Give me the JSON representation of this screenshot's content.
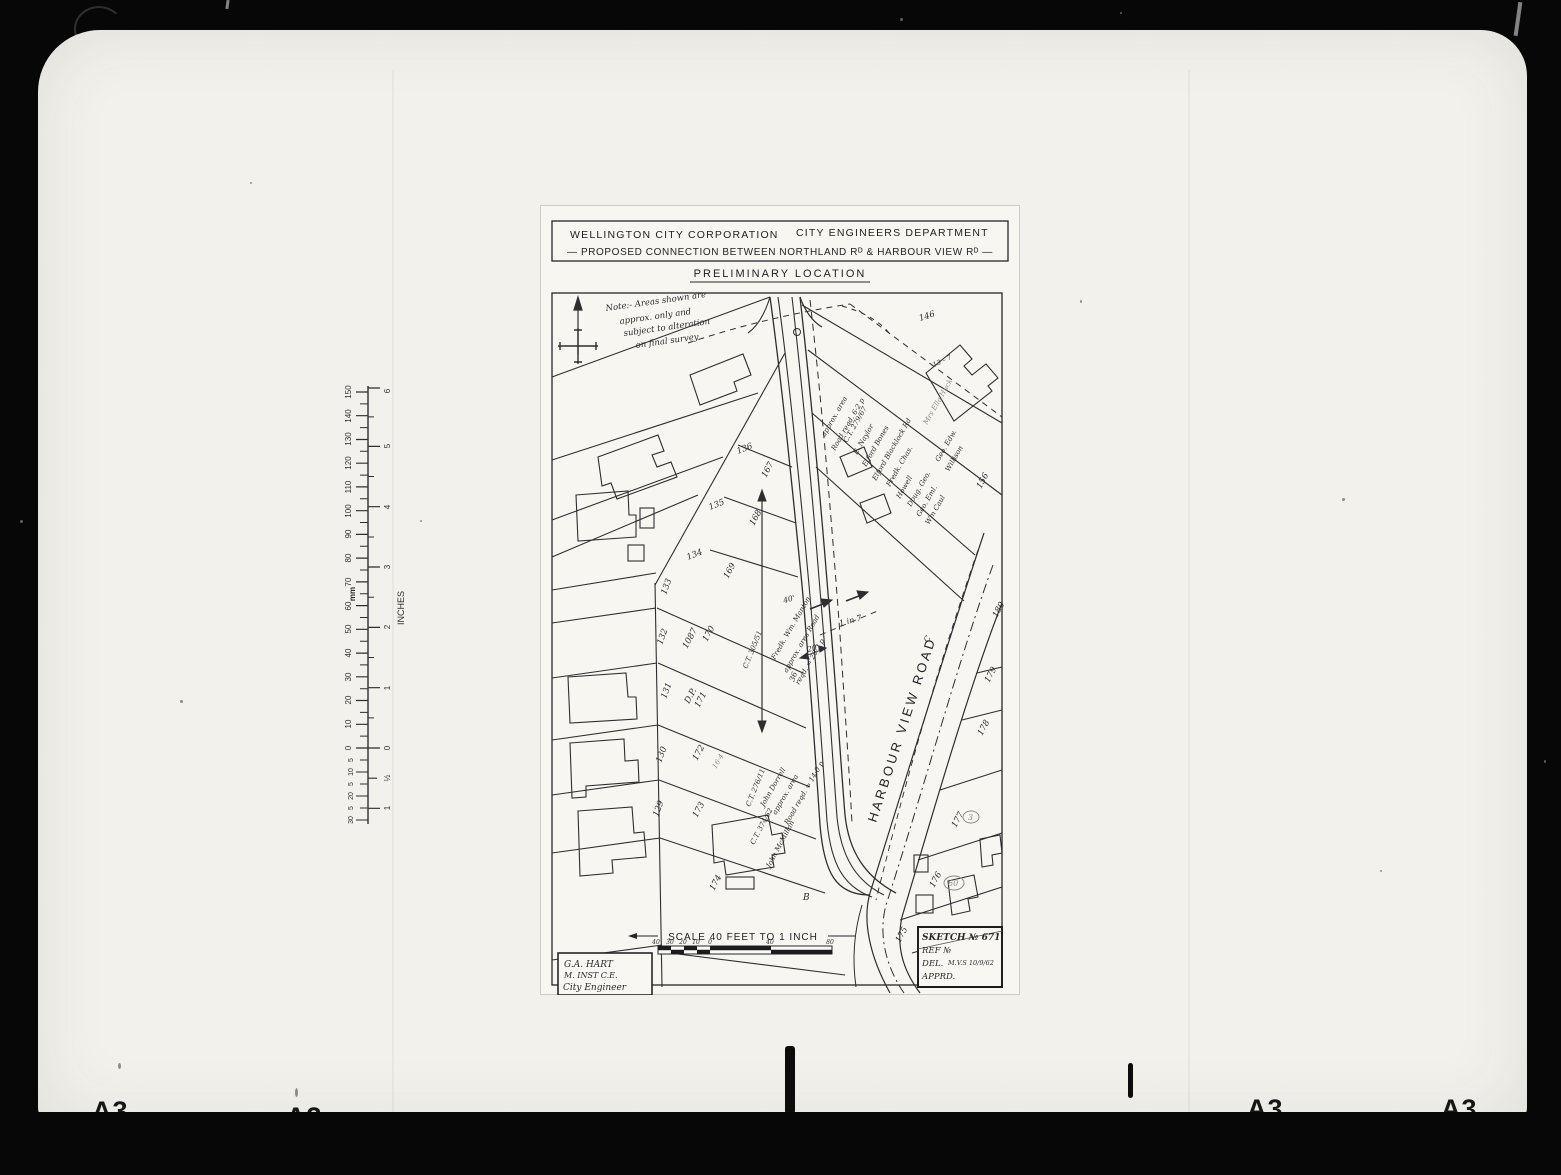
{
  "frame": {
    "a3_labels": [
      "A3",
      "A3",
      "A3",
      "A3"
    ]
  },
  "ruler": {
    "mm_unit": "mm",
    "inch_unit": "INCHES",
    "mm_numbers": [
      "150",
      "140",
      "130",
      "120",
      "110",
      "100",
      "90",
      "80",
      "70",
      "60",
      "50",
      "40",
      "30",
      "20",
      "10",
      "0"
    ],
    "mm_below_zero": [
      "5",
      "10",
      "5",
      "20",
      "5",
      "30"
    ],
    "inch_numbers": [
      "6",
      "5",
      "4",
      "3",
      "2",
      "1",
      "0"
    ],
    "inch_below_zero": [
      "½",
      "1"
    ]
  },
  "title_block": {
    "organisation": "WELLINGTON CITY CORPORATION",
    "department": "CITY ENGINEERS DEPARTMENT",
    "subject": "— PROPOSED CONNECTION BETWEEN NORTHLAND Rᴰ & HARBOUR VIEW Rᴰ —",
    "stage": "PRELIMINARY LOCATION"
  },
  "map": {
    "note": [
      "Note:- Areas shown are",
      "approx. only and",
      "subject to alteration",
      "on final survey"
    ],
    "road_name": "HARBOUR VIEW ROAD",
    "centerline_letter": "C",
    "point_b": "B",
    "lot_numbers": [
      "136",
      "135",
      "134",
      "133",
      "132",
      "131",
      "130",
      "129",
      "170",
      "171",
      "172",
      "173",
      "174",
      "175",
      "176",
      "177",
      "178",
      "179",
      "180",
      "146",
      "156",
      "167",
      "168",
      "169"
    ],
    "plan_ref": {
      "dp": "D.P.",
      "number": "1087"
    },
    "dimensions": {
      "d40": "40'",
      "d20": "20'",
      "d36": "36",
      "grade": "1 in 7",
      "house": "13 – 7"
    },
    "pencil_marks": [
      "60",
      "3"
    ],
    "annotations": {
      "manton": [
        "C.T. 305/51",
        "Fredk. Wm. Manton",
        "approx. area  Road",
        "reqd. = 20·2 p"
      ],
      "dorrell": [
        "C.T. 276/11",
        "John Dorrell",
        "approx. area",
        "Road reqd. = 14·0 p"
      ],
      "mcmillan": [
        "C.T. 374/62",
        "John McMillan"
      ],
      "owners": [
        "approx. area",
        "Road reqd. 6·2 p",
        "C.T. 279/67",
        "E. Naylor",
        "Elford Bones",
        "Elford Blacklock Rd",
        "Fredk. Chas.",
        "Howell",
        "Doug. Geo.",
        "Geo. Eml.",
        "Wm Caul",
        "Geo. Edw.",
        "Willison"
      ],
      "pencil_name": "Mrs Ella Huck",
      "pencil_area": "16·4"
    }
  },
  "scale_bar": {
    "label": "SCALE 40 FEET TO 1 INCH",
    "left_ticks": [
      "40",
      "30",
      "20",
      "10"
    ],
    "zero": "0",
    "right_ticks": [
      "40",
      "80"
    ]
  },
  "signature_block": [
    "G.A. HART",
    "M. INST C.E.",
    "City Engineer"
  ],
  "sketch_block": {
    "sketch": "SKETCH № 671",
    "ref": "REF №",
    "del": "DEL.",
    "del_value": "M.V.S 10/9/62",
    "apprd": "APPRD."
  }
}
